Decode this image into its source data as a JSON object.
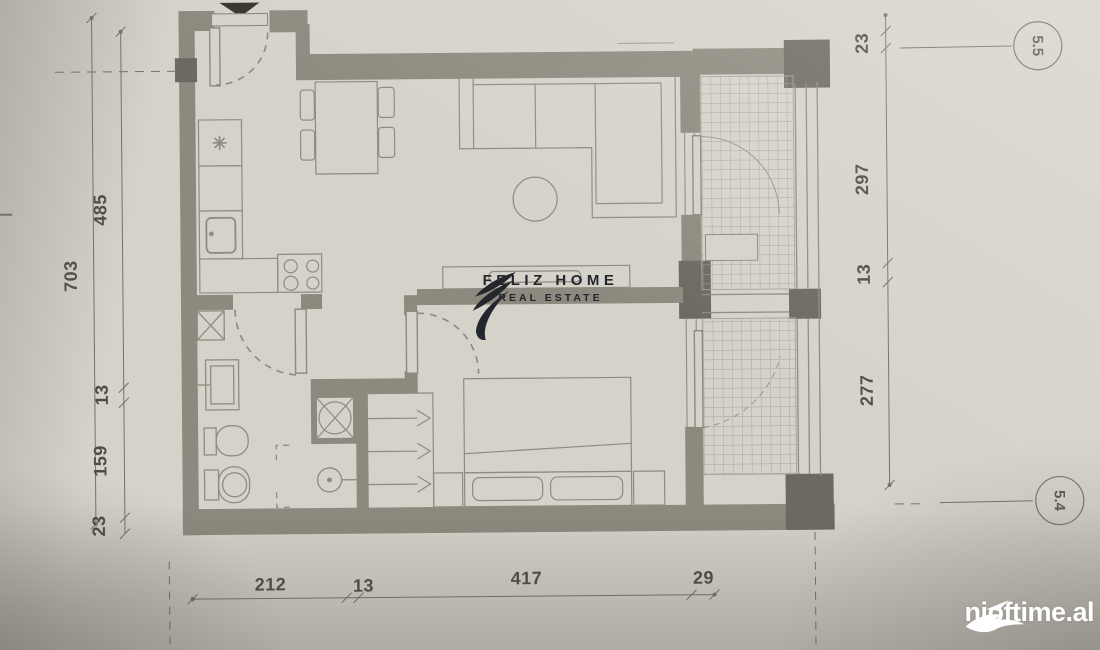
{
  "colors": {
    "paper": "#d5d2ca",
    "wall": "#8d897e",
    "wall_dark": "#6d6960",
    "thin_line": "#8f8b80",
    "dimension_text": "#4f4c44",
    "logo_ink": "#23262d",
    "watermark": "#ffffff"
  },
  "plan": {
    "dimensions": {
      "left_total": "703",
      "left": [
        "485",
        "13",
        "159",
        "23"
      ],
      "right": [
        "23",
        "297",
        "13",
        "277"
      ],
      "bottom": [
        "212",
        "13",
        "417",
        "29"
      ]
    },
    "axis_markers": [
      "5.5",
      "5.4"
    ]
  },
  "logo": {
    "title": "FELIZ HOME",
    "subtitle": "REAL ESTATE"
  },
  "watermark": {
    "site": "njoftime.al"
  }
}
